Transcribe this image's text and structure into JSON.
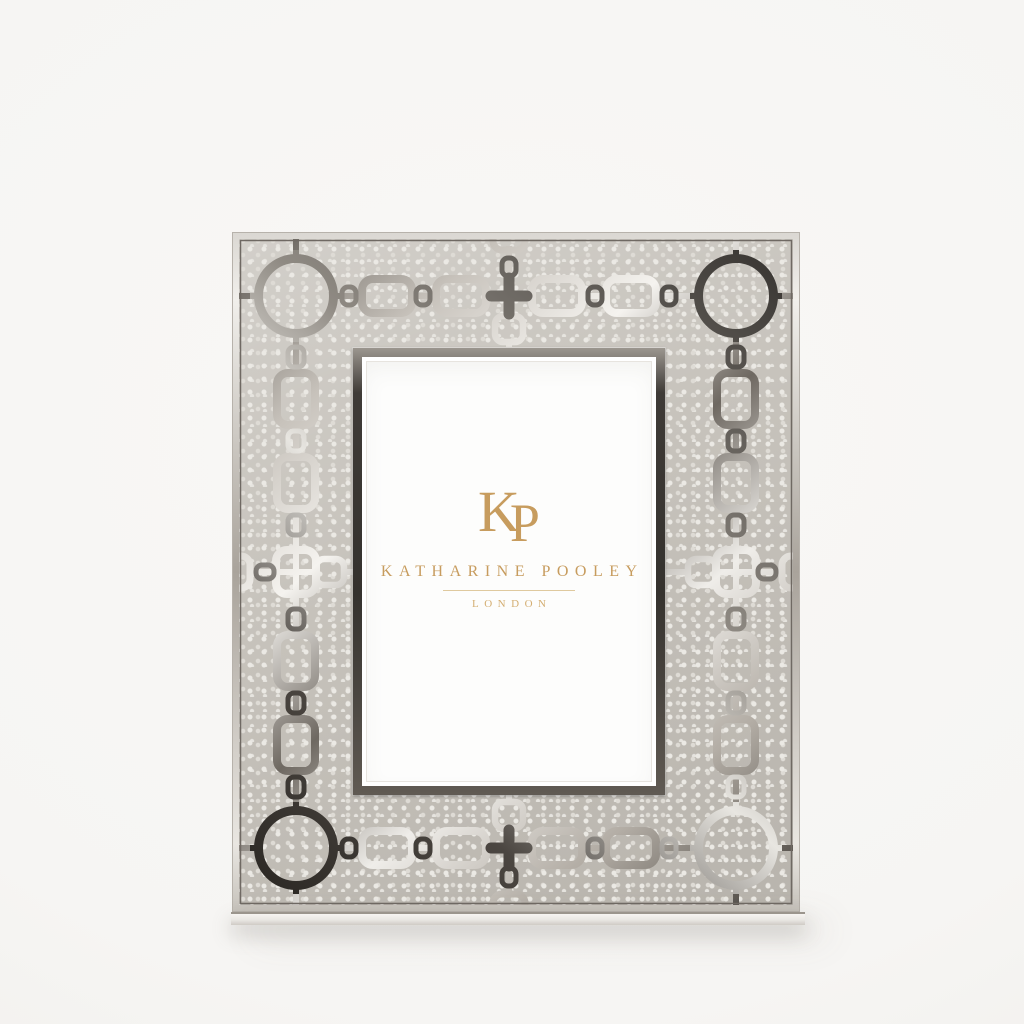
{
  "brand": {
    "monogram_k": "K",
    "monogram_p": "P",
    "name": "KATHARINE POOLEY",
    "city": "LONDON"
  },
  "colors": {
    "page_bg": "#f6f5f3",
    "shagreen_base": "#c6c2bb",
    "shagreen_dot": "#ebe9e4",
    "shagreen_dot2": "#dedbd5",
    "nickel_dark": "#3a3631",
    "nickel_bright": "#f3f1ed",
    "aperture_dark": "#3f3b37",
    "mat_white": "#fdfdfc",
    "gold": "#c79c5e",
    "gold_light": "#d4ae72",
    "divider_gold": "#dfc99e"
  }
}
